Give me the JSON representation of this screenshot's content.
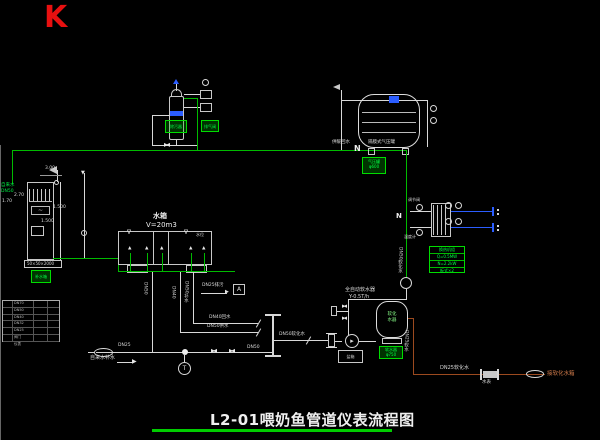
{
  "corner_marker": "K",
  "title": "L2-01喂奶鱼管道仪表流程图",
  "feed_riser": {
    "line1": "自来水",
    "line2": "DN50"
  },
  "filter_unit": {
    "tag_left": "除污器",
    "tag_right": "排气阀"
  },
  "expansion_tank": {
    "label_left": "供暖回水",
    "n_marker": "N",
    "label_right": "隔膜式气压罐",
    "tag_line1": "气压罐",
    "tag_line2": "φ600"
  },
  "left_tank": {
    "dim_top": "3.00",
    "dim_left1": "2.70",
    "dim_left2": "1.70",
    "dim_right1": "1.500",
    "dim_right2": "1.500",
    "base_label": "50×50×2000",
    "tag": "补水箱"
  },
  "legend_rows": [
    "DN70",
    "DN50",
    "DN40",
    "DN32",
    "DN25",
    "阀门",
    "仪表"
  ],
  "main_tank": {
    "name": "水箱",
    "volume": "V=20m3",
    "note": "水位"
  },
  "heat_exchanger": {
    "n_marker": "N",
    "label_top": "调节阀",
    "label_bottom": "温度计",
    "table_rows": [
      "换热机组",
      "Q=0.5MW",
      "N=2.2kW",
      "板式×2"
    ]
  },
  "softener": {
    "title1": "全自动软水器",
    "title2": "Y-0.5T/h",
    "vessel_line1": "软化",
    "vessel_line2": "水器",
    "tag_line1": "软水器",
    "tag_line2": "φ750",
    "skid": "盐箱"
  },
  "pipe_labels": {
    "right_drop": "DN50软化水",
    "down1": "DN50",
    "down2": "DN40",
    "down3": "DN50补水",
    "drain": "DN25排污",
    "drain_box": "A",
    "return_line": "DN40回水",
    "supply_line": "DN50供水",
    "branch": "DN50软化水",
    "bottom_small": "DN25",
    "bottom_mid": "DN50",
    "feed": "自来水补水",
    "gauge": "T"
  },
  "orange_line": {
    "riser": "DN25软水",
    "label": "DN25软化水",
    "meter": "水表",
    "end_label": "接软化水箱"
  }
}
